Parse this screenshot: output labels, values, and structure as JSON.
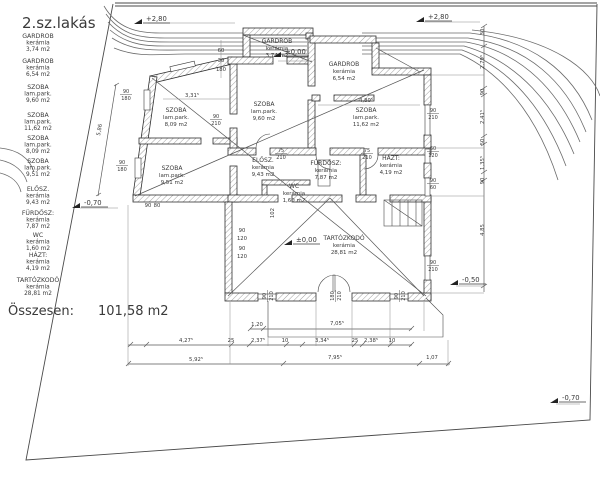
{
  "title": "2.sz.lakás",
  "legend": {
    "total_label": "Összesen:",
    "total_value": "101,58 m2",
    "items": [
      {
        "name": "GARDROB",
        "finish": "kerámia",
        "area": "3,74 m2",
        "y": 38
      },
      {
        "name": "GARDROB",
        "finish": "kerámia",
        "area": "6,54 m2",
        "y": 63
      },
      {
        "name": "SZOBA",
        "finish": "lam.park.",
        "area": "9,60 m2",
        "y": 89
      },
      {
        "name": "SZOBA",
        "finish": "lam.park.",
        "area": "11,62 m2",
        "y": 117
      },
      {
        "name": "SZOBA",
        "finish": "lam.park.",
        "area": "8,09 m2",
        "y": 140
      },
      {
        "name": "SZOBA",
        "finish": "lam.park.",
        "area": "9,51 m2",
        "y": 163
      },
      {
        "name": "ELŐSZ.",
        "finish": "kerámia",
        "area": "9,43 m2",
        "y": 191
      },
      {
        "name": "FÜRDŐSZ:",
        "finish": "kerámia",
        "area": "7,87 m2",
        "y": 215
      },
      {
        "name": "WC",
        "finish": "kerámia",
        "area": "1,60 m2",
        "y": 237
      },
      {
        "name": "HÁZT:",
        "finish": "kerámia",
        "area": "4,19 m2",
        "y": 257
      },
      {
        "name": "TARTÓZKODÓ",
        "finish": "kerámia",
        "area": "28,81 m2",
        "y": 282
      }
    ]
  },
  "plan": {
    "room_labels": [
      {
        "name": "GARDROB",
        "finish": "kerámia",
        "area": "3,74 m2",
        "x": 277,
        "y": 43
      },
      {
        "name": "GARDROB",
        "finish": "kerámia",
        "area": "6,54 m2",
        "x": 344,
        "y": 66
      },
      {
        "name": "SZOBA",
        "finish": "lam.park.",
        "area": "9,60 m2",
        "x": 264,
        "y": 106
      },
      {
        "name": "SZOBA",
        "finish": "lam.park.",
        "area": "11,62 m2",
        "x": 366,
        "y": 112
      },
      {
        "name": "SZOBA",
        "finish": "lam.park.",
        "area": "8,09 m2",
        "x": 176,
        "y": 112
      },
      {
        "name": "SZOBA",
        "finish": "lam.park.",
        "area": "9,51 m2",
        "x": 172,
        "y": 170
      },
      {
        "name": "ELŐSZ.",
        "finish": "kerámia",
        "area": "9,43 m2",
        "x": 263,
        "y": 162
      },
      {
        "name": "FÜRDŐSZ:",
        "finish": "kerámia",
        "area": "7,87 m2",
        "x": 326,
        "y": 165
      },
      {
        "name": "WC",
        "finish": "kerámia",
        "area": "1,60 m2",
        "x": 294,
        "y": 188
      },
      {
        "name": "HÁZT:",
        "finish": "kerámia",
        "area": "4,19 m2",
        "x": 391,
        "y": 160
      },
      {
        "name": "TARTÓZKODÓ",
        "finish": "kerámia",
        "area": "28,81 m2",
        "x": 344,
        "y": 240
      }
    ],
    "level_markers": [
      {
        "t": "+2,80",
        "x": 146,
        "y": 21
      },
      {
        "t": "+2,80",
        "x": 428,
        "y": 19
      },
      {
        "t": "±0,00",
        "x": 285,
        "y": 54
      },
      {
        "t": "±0,00",
        "x": 296,
        "y": 242
      },
      {
        "t": "-0,70",
        "x": 84,
        "y": 205
      },
      {
        "t": "-0,50",
        "x": 462,
        "y": 282
      },
      {
        "t": "-0,70",
        "x": 562,
        "y": 400
      }
    ],
    "dim_labels": [
      {
        "t": "3,31⁵",
        "x": 192,
        "y": 97,
        "r": 0
      },
      {
        "t": "4,80⁵",
        "x": 366,
        "y": 102,
        "r": 0
      },
      {
        "t": "5,86",
        "x": 101,
        "y": 130,
        "r": -80
      },
      {
        "t": "4,27⁵",
        "x": 186,
        "y": 342,
        "r": 0
      },
      {
        "t": "25",
        "x": 231,
        "y": 342,
        "r": 0
      },
      {
        "t": "2,37⁵",
        "x": 258,
        "y": 342,
        "r": 0
      },
      {
        "t": "10",
        "x": 285,
        "y": 342,
        "r": 0
      },
      {
        "t": "3,34⁵",
        "x": 322,
        "y": 342,
        "r": 0
      },
      {
        "t": "25",
        "x": 355,
        "y": 342,
        "r": 0
      },
      {
        "t": "2,38⁵",
        "x": 371,
        "y": 342,
        "r": 0
      },
      {
        "t": "10",
        "x": 392,
        "y": 342,
        "r": 0
      },
      {
        "t": "1,20",
        "x": 257,
        "y": 326,
        "r": 0
      },
      {
        "t": "7,05⁵",
        "x": 337,
        "y": 325,
        "r": 0
      },
      {
        "t": "5,92⁵",
        "x": 196,
        "y": 361,
        "r": 0
      },
      {
        "t": "7,95⁵",
        "x": 335,
        "y": 359,
        "r": 0
      },
      {
        "t": "1,07",
        "x": 432,
        "y": 359,
        "r": 0
      },
      {
        "t": "30",
        "x": 484,
        "y": 32,
        "r": -90
      },
      {
        "t": "2,79⁵",
        "x": 484,
        "y": 62,
        "r": -90
      },
      {
        "t": "90",
        "x": 484,
        "y": 92,
        "r": -90
      },
      {
        "t": "2,41⁵",
        "x": 484,
        "y": 117,
        "r": -90
      },
      {
        "t": "50",
        "x": 484,
        "y": 142,
        "r": -90
      },
      {
        "t": "1,35⁵",
        "x": 484,
        "y": 163,
        "r": -90
      },
      {
        "t": "90",
        "x": 484,
        "y": 181,
        "r": -90
      },
      {
        "t": "4,85",
        "x": 484,
        "y": 230,
        "r": -90
      },
      {
        "t": "60",
        "x": 221,
        "y": 52,
        "r": 0
      },
      {
        "t": "30",
        "x": 221,
        "y": 62,
        "r": 0
      },
      {
        "t": "180",
        "x": 221,
        "y": 71,
        "r": 0
      },
      {
        "t": "90",
        "x": 148,
        "y": 207,
        "r": 0
      },
      {
        "t": "80",
        "x": 157,
        "y": 207,
        "r": 0
      },
      {
        "t": "90",
        "x": 242,
        "y": 232,
        "r": 0
      },
      {
        "t": "120",
        "x": 242,
        "y": 240,
        "r": 0
      },
      {
        "t": "90",
        "x": 242,
        "y": 250,
        "r": 0
      },
      {
        "t": "120",
        "x": 242,
        "y": 258,
        "r": 0
      },
      {
        "t": "102",
        "x": 274,
        "y": 213,
        "r": -90
      }
    ],
    "window_labels": [
      {
        "x": 126,
        "y": 93,
        "a": "90",
        "b": "180",
        "r": 0
      },
      {
        "x": 122,
        "y": 164,
        "a": "90",
        "b": "180",
        "r": 0
      },
      {
        "x": 216,
        "y": 118,
        "a": "90",
        "b": "210",
        "r": 0
      },
      {
        "x": 281,
        "y": 152,
        "a": "75",
        "b": "210",
        "r": 0
      },
      {
        "x": 367,
        "y": 152,
        "a": "75",
        "b": "210",
        "r": 0
      },
      {
        "x": 433,
        "y": 112,
        "a": "90",
        "b": "210",
        "r": 0
      },
      {
        "x": 433,
        "y": 150,
        "a": "60",
        "b": "120",
        "r": 0
      },
      {
        "x": 433,
        "y": 182,
        "a": "90",
        "b": "60",
        "r": 0
      },
      {
        "x": 433,
        "y": 264,
        "a": "90",
        "b": "210",
        "r": 0
      },
      {
        "x": 266,
        "y": 296,
        "a": "90",
        "b": "210",
        "r": -90
      },
      {
        "x": 334,
        "y": 296,
        "a": "180",
        "b": "210",
        "r": -90
      },
      {
        "x": 398,
        "y": 296,
        "a": "90",
        "b": "210",
        "r": -90
      }
    ]
  }
}
